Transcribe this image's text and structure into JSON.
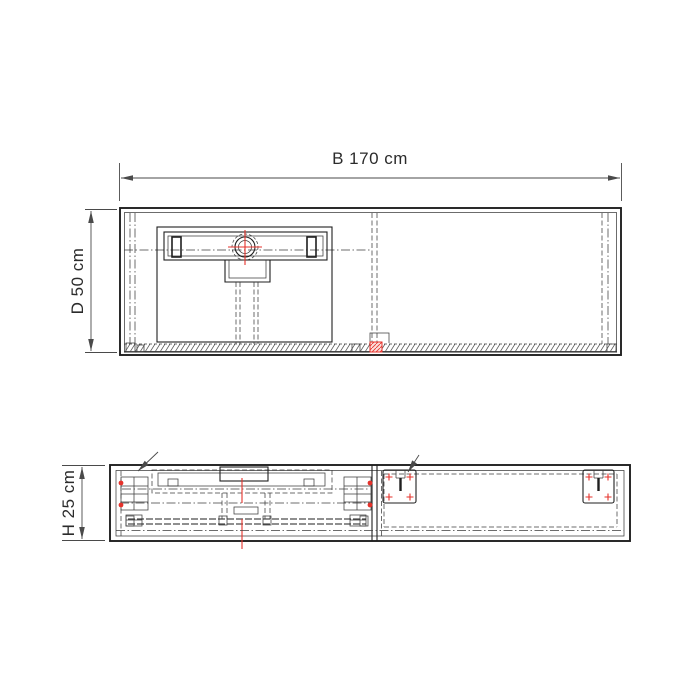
{
  "drawing": {
    "dim_width": {
      "label": "B 170 cm",
      "value_cm": 170,
      "axis": "width"
    },
    "dim_depth": {
      "label": "D 50 cm",
      "value_cm": 50,
      "axis": "depth"
    },
    "dim_height": {
      "label": "H 25 cm",
      "value_cm": 25,
      "axis": "height"
    },
    "colors": {
      "background": "#ffffff",
      "line": "#1f1f1f",
      "detail": "#3c3c3c",
      "dim": "#4a4a4a",
      "red": "#e5322b",
      "red_fill": "#fbdedb"
    }
  }
}
